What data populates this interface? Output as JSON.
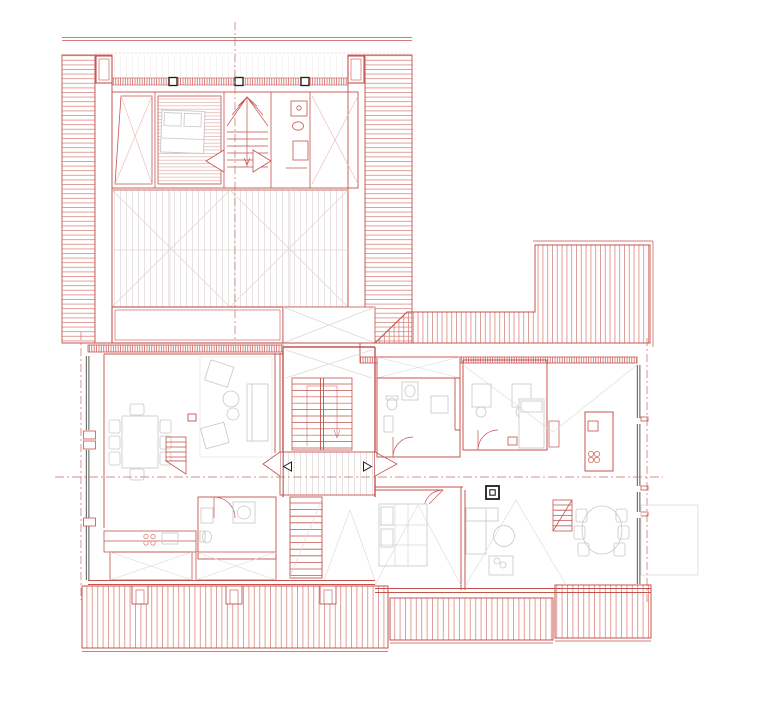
{
  "drawing": {
    "colors": {
      "background": "#ffffff",
      "line_red": "#c4534e",
      "hatch_red": "#d98880",
      "plank_red": "#e0a39d",
      "faint_red": "#e7b6b1",
      "furniture_gray": "#c7c7c7",
      "faint_gray": "#ded7d5",
      "glazing_dark": "#454545",
      "marker_black": "#1e1e1e",
      "axis_red": "#cd6a63",
      "paper_white": "#ffffff"
    }
  }
}
